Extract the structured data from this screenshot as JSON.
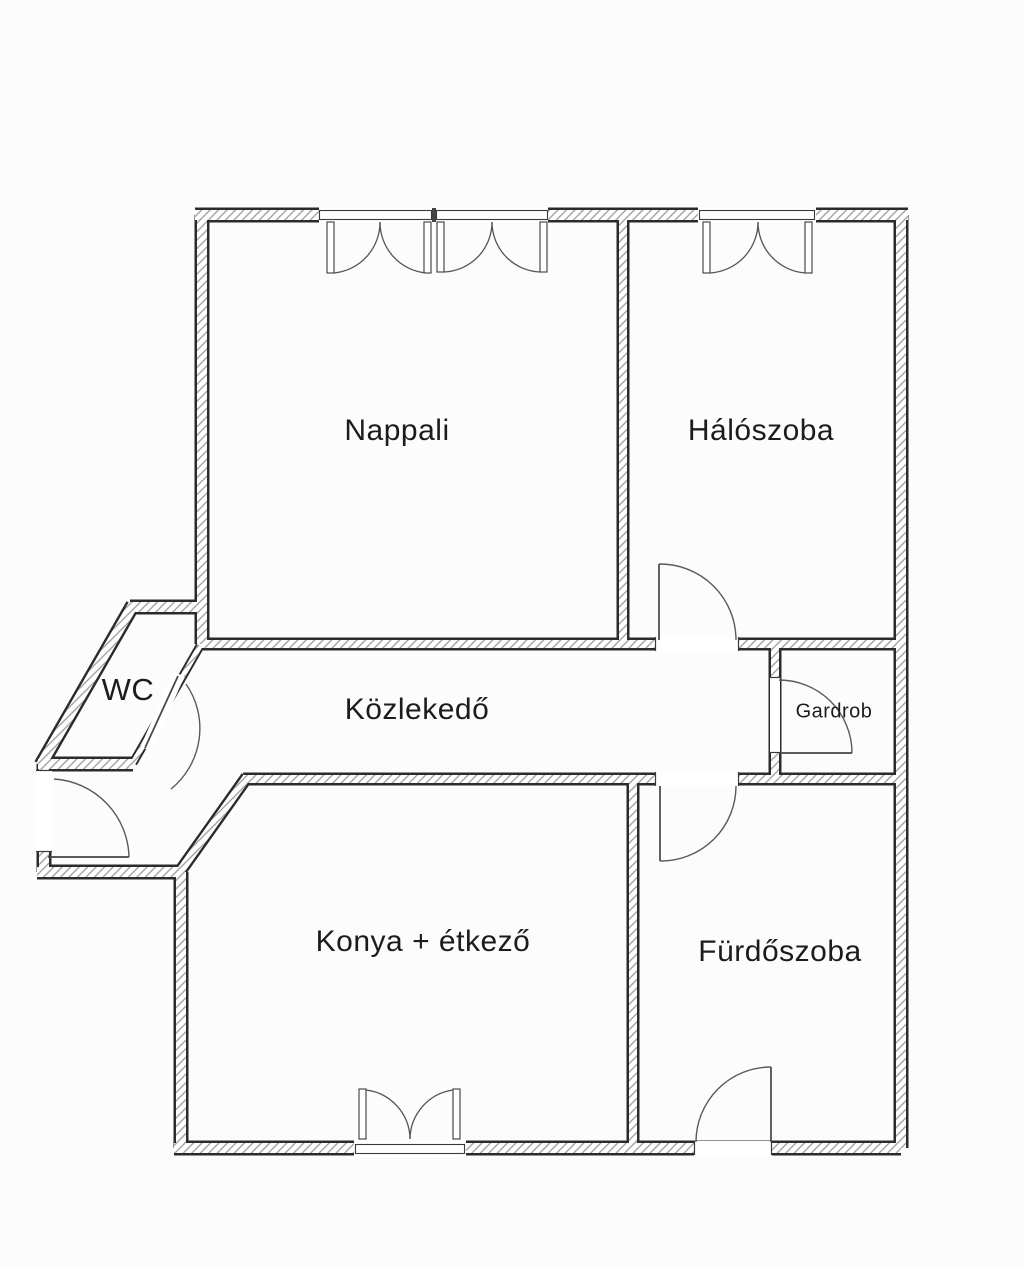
{
  "floorplan": {
    "rooms": [
      {
        "id": "nappali",
        "label": "Nappali"
      },
      {
        "id": "haloszoba",
        "label": "Hálószoba"
      },
      {
        "id": "wc",
        "label": "WC"
      },
      {
        "id": "kozlekedo",
        "label": "Közlekedő"
      },
      {
        "id": "gardrob",
        "label": "Gardrob"
      },
      {
        "id": "konyha",
        "label": "Konya + étkező"
      },
      {
        "id": "furdoszoba",
        "label": "Fürdőszoba"
      }
    ],
    "colors": {
      "wall_line": "#2b2b2b",
      "hatch": "#9b9b9b",
      "background": "#fcfcfc",
      "label_text": "#1c1c1c"
    }
  }
}
